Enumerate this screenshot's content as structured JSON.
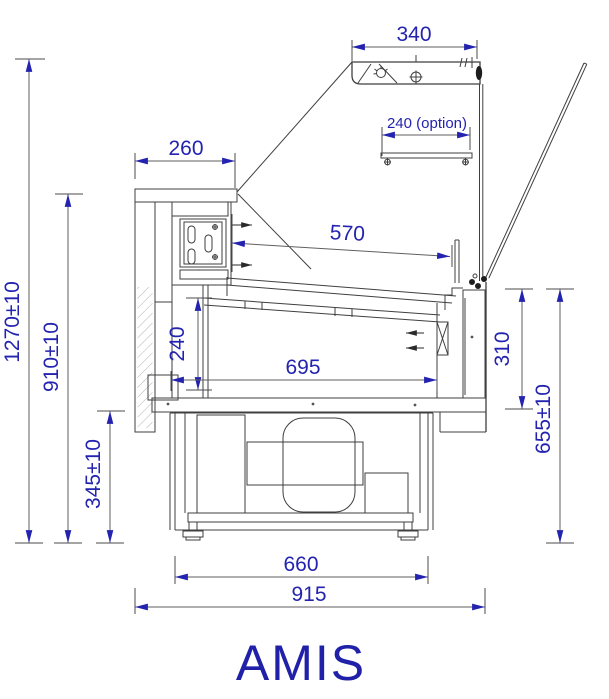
{
  "title": "AMIS",
  "colors": {
    "dimension_text": "#2323b0",
    "structure_line": "#3f3f3f",
    "background": "#ffffff"
  },
  "dims": {
    "canopy_width": "340",
    "shelf_option": "240 (option)",
    "rear_counter_width": "260",
    "deck_length": "570",
    "well_inner_height": "240",
    "well_inner_length": "695",
    "front_wall_height": "310",
    "front_total_height": "655±10",
    "overall_height": "1270±10",
    "counter_top_height": "910±10",
    "base_clearance_height": "345±10",
    "base_frame_width": "660",
    "overall_depth": "915"
  }
}
